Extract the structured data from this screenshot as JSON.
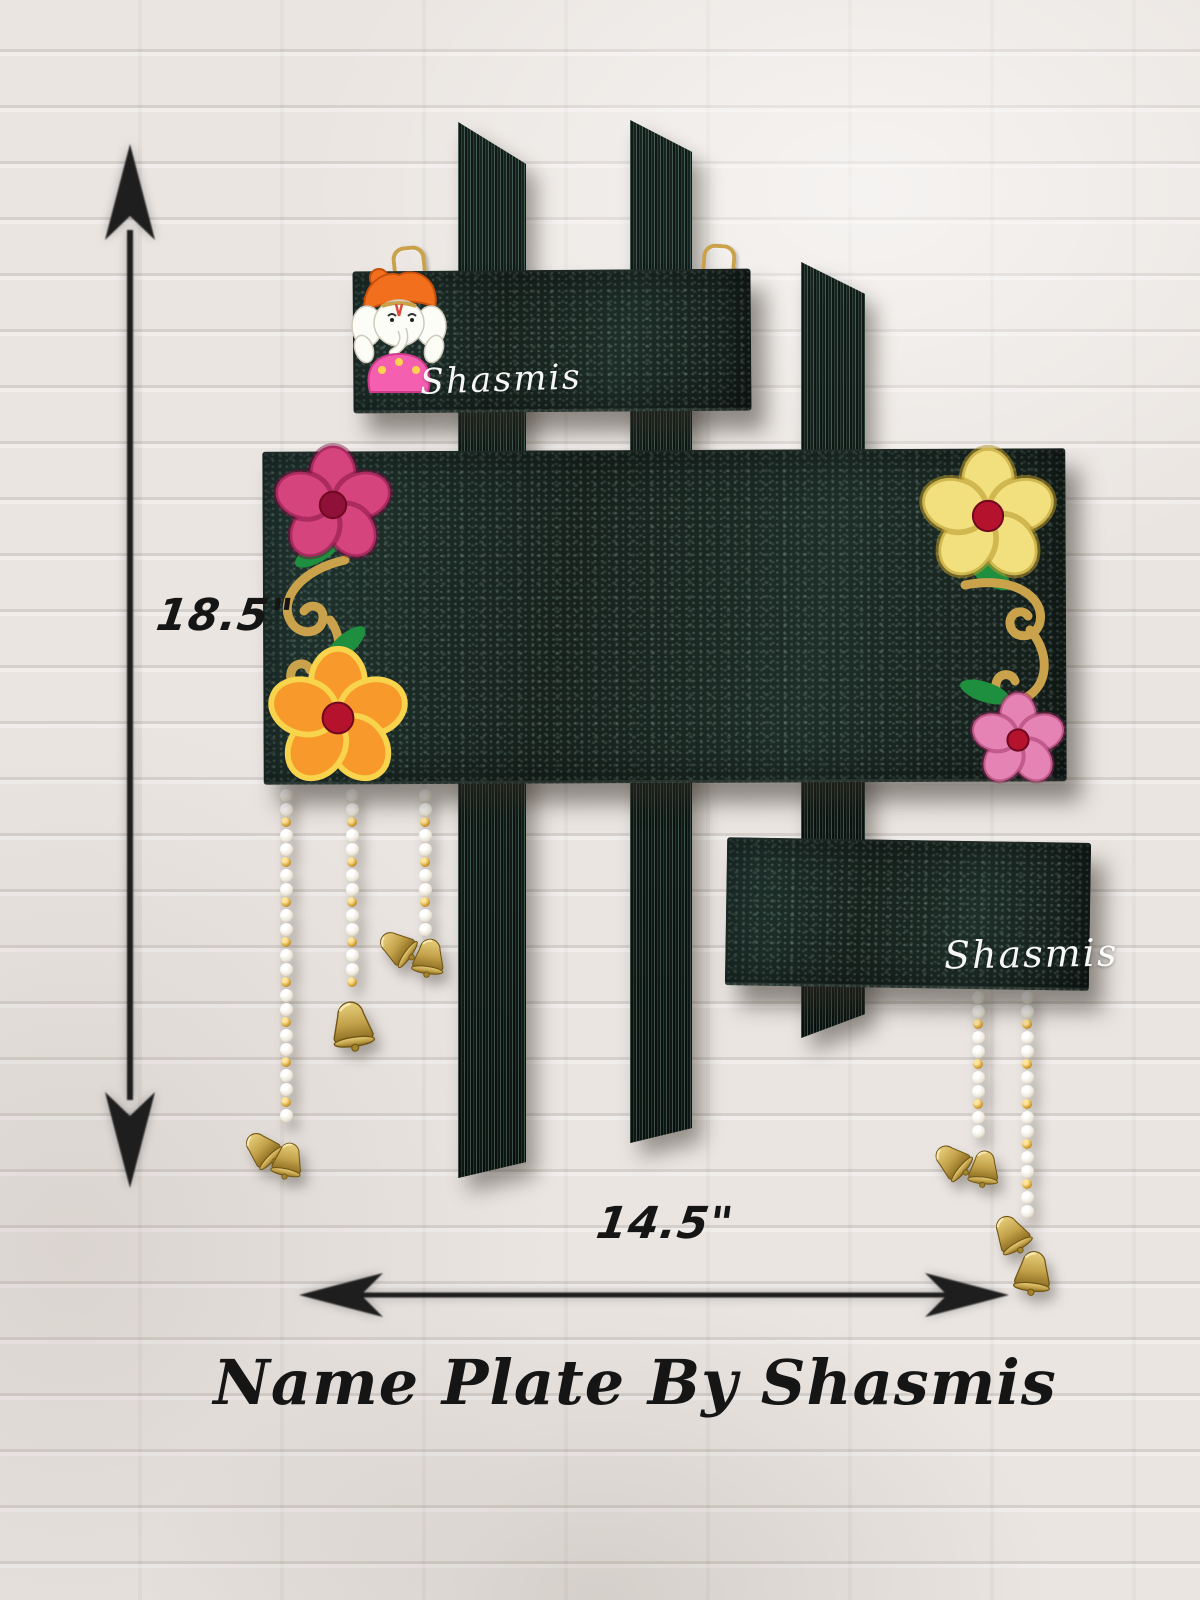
{
  "product": {
    "title": "Name Plate By Shasmis",
    "watermark": "Shasmis",
    "height_label": "18.5\"",
    "width_label": "14.5\""
  },
  "scene": {
    "subject": "handcrafted-wooden-name-plate",
    "background": "white-painted-brick-wall",
    "icons": [
      "ganesha-figurine",
      "flower",
      "gold-swirl",
      "leaf",
      "pearl-bead-string",
      "brass-bell",
      "dimension-arrow",
      "hanging-hook"
    ]
  },
  "colors": {
    "wall_base": "#eae5e1",
    "plank_dark": "#1b2a25",
    "plank_mid": "#213530",
    "gold": "#caa24b",
    "gold_deep": "#a97f2f",
    "leaf_green": "#1e8f3e",
    "flower_pink": "#d6447e",
    "flower_orange": "#f79a2b",
    "flower_orange_edge": "#f7d44c",
    "flower_yellow": "#f2e07e",
    "flower_light_pink": "#e583b4",
    "flower_center": "#b5122e",
    "pearl": "#efe9dc",
    "gold_bead": "#cf9a2e",
    "brass_light": "#e8cf7d",
    "brass_dark": "#8a6b20",
    "turban_orange": "#f2701d",
    "ganesha_white": "#fdfdf8",
    "ganesha_pink": "#f45fb0",
    "ink": "#151515",
    "watermark": "#ffffff"
  },
  "decor": {
    "flowers": [
      {
        "name": "pink-flower",
        "x": 333,
        "y": 505,
        "r": 55,
        "petal": "#d6447e",
        "edge": "rgba(120,10,60,0.45)",
        "center": "#8f1038"
      },
      {
        "name": "orange-flower",
        "x": 338,
        "y": 718,
        "r": 64,
        "petal": "#f79a2b",
        "edge": "#f7d44c",
        "center": "#b5122e"
      },
      {
        "name": "yellow-flower",
        "x": 988,
        "y": 516,
        "r": 63,
        "petal": "#f2e07e",
        "edge": "rgba(180,150,40,0.55)",
        "center": "#b5122e"
      },
      {
        "name": "light-pink-flower",
        "x": 1018,
        "y": 740,
        "r": 44,
        "petal": "#e583b4",
        "edge": "rgba(150,40,90,0.45)",
        "center": "#b5122e"
      }
    ],
    "bead_strings": [
      {
        "x": 286,
        "top": 788,
        "length": 332,
        "bells": [
          {
            "dx": -24,
            "dy": 340,
            "size": 42,
            "rot": -45
          },
          {
            "dx": 2,
            "dy": 352,
            "size": 40,
            "rot": 12
          }
        ]
      },
      {
        "x": 352,
        "top": 788,
        "length": 208,
        "bells": [
          {
            "dx": 0,
            "dy": 210,
            "size": 54,
            "rot": -8
          }
        ]
      },
      {
        "x": 425,
        "top": 788,
        "length": 148,
        "bells": [
          {
            "dx": -28,
            "dy": 138,
            "size": 42,
            "rot": -55
          },
          {
            "dx": 4,
            "dy": 148,
            "size": 42,
            "rot": 8
          }
        ]
      },
      {
        "x": 978,
        "top": 990,
        "length": 150,
        "bells": [
          {
            "dx": -26,
            "dy": 150,
            "size": 42,
            "rot": -50
          },
          {
            "dx": 6,
            "dy": 158,
            "size": 40,
            "rot": 6
          }
        ]
      },
      {
        "x": 1027,
        "top": 990,
        "length": 224,
        "bells": [
          {
            "dx": -16,
            "dy": 222,
            "size": 44,
            "rot": -30
          },
          {
            "dx": 6,
            "dy": 258,
            "size": 48,
            "rot": 6
          }
        ]
      }
    ],
    "bead_pattern": [
      "pearl",
      "pearl",
      "gold"
    ]
  }
}
